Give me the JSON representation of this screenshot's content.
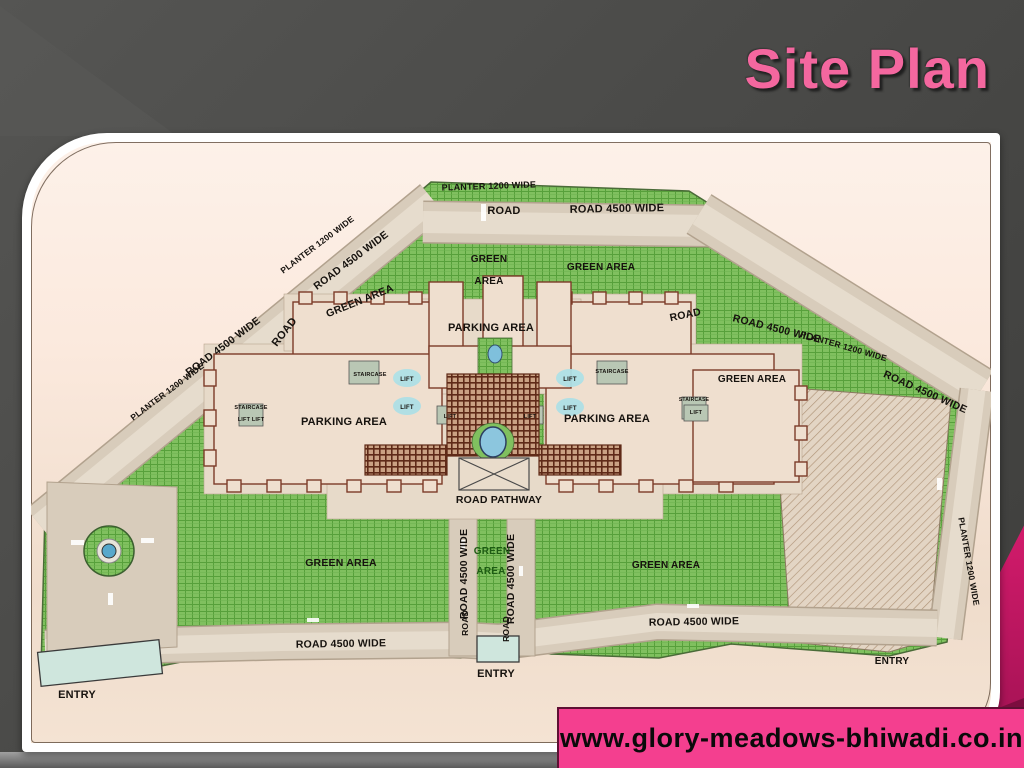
{
  "slide": {
    "title": "Site Plan",
    "footer_url": "www.glory-meadows-bhiwadi.co.in",
    "colors": {
      "title_pink": "#f4679f",
      "banner_pink": "#f43f8f",
      "crimson_accent": "#d41b6c",
      "slide_background": "#4a4a48",
      "panel_cream": "#fbe9dd"
    }
  },
  "site_plan": {
    "colors": {
      "green_area": "#80c05f",
      "road": "#d8ccbb",
      "building_outline": "#7c3b28",
      "building_fill": "#efdfcf",
      "trellis": "#5f2a18",
      "pool_blue": "#8cc6de",
      "gate_blue": "#cfe6dd",
      "label": "#16120e",
      "green_label": "#1e5c14"
    },
    "labels": [
      {
        "t": "PLANTER 1200 WIDE",
        "x": 458,
        "y": 47,
        "s": 9,
        "r": -2
      },
      {
        "t": "ROAD",
        "x": 473,
        "y": 72,
        "s": 11
      },
      {
        "t": "ROAD 4500 WIDE",
        "x": 586,
        "y": 70,
        "s": 11,
        "r": -1
      },
      {
        "t": "GREEN",
        "x": 458,
        "y": 120,
        "s": 10
      },
      {
        "t": "AREA",
        "x": 458,
        "y": 142,
        "s": 10
      },
      {
        "t": "GREEN AREA",
        "x": 570,
        "y": 128,
        "s": 10
      },
      {
        "t": "PLANTER 1200 WIDE",
        "x": 288,
        "y": 105,
        "s": 8.5,
        "r": -37
      },
      {
        "t": "ROAD 4500 WIDE",
        "x": 322,
        "y": 121,
        "s": 10.5,
        "r": -37
      },
      {
        "t": "GREEN AREA",
        "x": 330,
        "y": 162,
        "s": 10.5,
        "r": -22
      },
      {
        "t": "ROAD",
        "x": 256,
        "y": 192,
        "s": 11,
        "r": -52
      },
      {
        "t": "ROAD 4500 WIDE",
        "x": 194,
        "y": 207,
        "s": 10.5,
        "r": -37
      },
      {
        "t": "PLANTER 1200 WIDE",
        "x": 138,
        "y": 252,
        "s": 8.5,
        "r": -37
      },
      {
        "t": "ROAD",
        "x": 655,
        "y": 176,
        "s": 10.5,
        "r": -12
      },
      {
        "t": "ROAD 4500 WIDE",
        "x": 745,
        "y": 190,
        "s": 10.5,
        "r": 14
      },
      {
        "t": "PLANTER 1200 WIDE",
        "x": 812,
        "y": 207,
        "s": 8.5,
        "r": 16
      },
      {
        "t": "ROAD 4500 WIDE",
        "x": 893,
        "y": 253,
        "s": 10.5,
        "r": 24
      },
      {
        "t": "GREEN AREA",
        "x": 721,
        "y": 240,
        "s": 10
      },
      {
        "t": "PLANTER 1200 WIDE",
        "x": 935,
        "y": 420,
        "s": 8.5,
        "r": 80
      },
      {
        "t": "PARKING AREA",
        "x": 460,
        "y": 189,
        "s": 11
      },
      {
        "t": "STAIRCASE",
        "x": 339,
        "y": 234,
        "s": 5.5
      },
      {
        "t": "STAIRCASE",
        "x": 581,
        "y": 231,
        "s": 5.5
      },
      {
        "t": "LIFT",
        "x": 376,
        "y": 239,
        "s": 6
      },
      {
        "t": "LIFT",
        "x": 376,
        "y": 267,
        "s": 6
      },
      {
        "t": "LIFT",
        "x": 539,
        "y": 239,
        "s": 6
      },
      {
        "t": "LIFT",
        "x": 539,
        "y": 268,
        "s": 6
      },
      {
        "t": "LIFT",
        "x": 419,
        "y": 276,
        "s": 5.5
      },
      {
        "t": "LIFT",
        "x": 499,
        "y": 276,
        "s": 5.5
      },
      {
        "t": "STAIRCASE",
        "x": 663,
        "y": 259,
        "s": 5
      },
      {
        "t": "LIFT",
        "x": 665,
        "y": 272,
        "s": 5.5
      },
      {
        "t": "STAIRCASE",
        "x": 220,
        "y": 267,
        "s": 5.5
      },
      {
        "t": "LIFT  LIFT",
        "x": 220,
        "y": 279,
        "s": 5.5
      },
      {
        "t": "PARKING AREA",
        "x": 313,
        "y": 283,
        "s": 11
      },
      {
        "t": "PARKING AREA",
        "x": 576,
        "y": 280,
        "s": 11
      },
      {
        "t": "ROAD PATHWAY",
        "x": 468,
        "y": 361,
        "s": 10.5
      },
      {
        "t": "ROAD 4500 WIDE",
        "x": 436,
        "y": 432,
        "s": 10.5,
        "r": -90
      },
      {
        "t": "ROAD 4500 WIDE",
        "x": 483,
        "y": 437,
        "s": 10.5,
        "r": -90
      },
      {
        "t": "GREEN",
        "x": 461,
        "y": 412,
        "s": 10,
        "c": "#1e5c14"
      },
      {
        "t": "AREA",
        "x": 460,
        "y": 432,
        "s": 10,
        "c": "#1e5c14"
      },
      {
        "t": "GREEN AREA",
        "x": 310,
        "y": 424,
        "s": 10.5
      },
      {
        "t": "GREEN AREA",
        "x": 635,
        "y": 426,
        "s": 10
      },
      {
        "t": "ROAD 4500 WIDE",
        "x": 310,
        "y": 505,
        "s": 10.5,
        "r": -1
      },
      {
        "t": "ROAD 4500 WIDE",
        "x": 663,
        "y": 483,
        "s": 10.5,
        "r": -1
      },
      {
        "t": "ROAD",
        "x": 437,
        "y": 481,
        "s": 8.5,
        "r": -90
      },
      {
        "t": "ROAD",
        "x": 478,
        "y": 487,
        "s": 8.5,
        "r": -90
      },
      {
        "t": "ENTRY",
        "x": 46,
        "y": 556,
        "s": 11
      },
      {
        "t": "ENTRY",
        "x": 465,
        "y": 535,
        "s": 11
      },
      {
        "t": "ENTRY",
        "x": 861,
        "y": 522,
        "s": 10
      }
    ]
  }
}
